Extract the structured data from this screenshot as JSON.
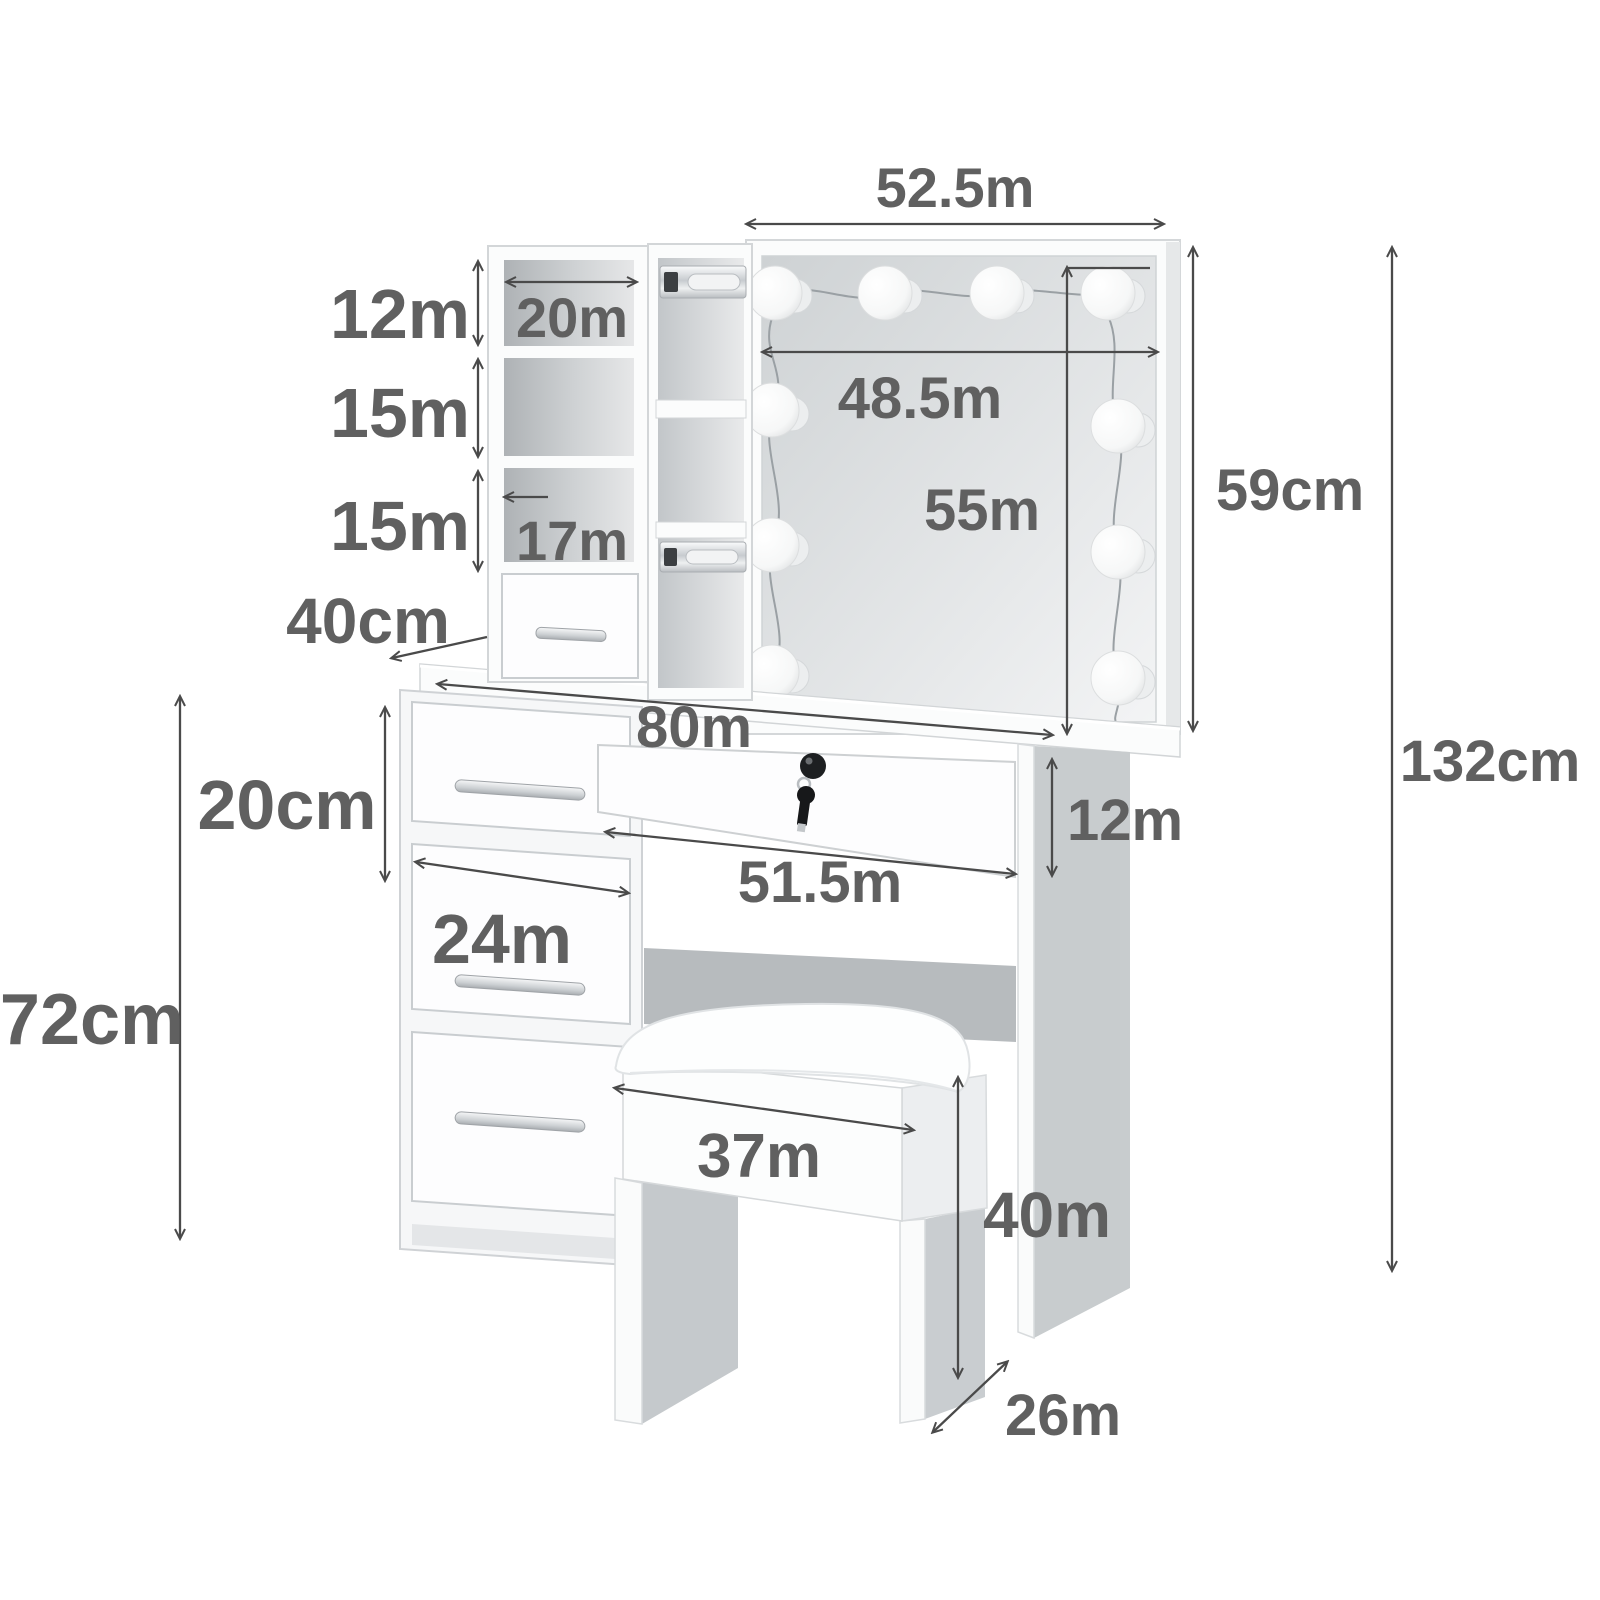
{
  "figure": {
    "kind": "furniture-dimension-diagram",
    "background": "#ffffff"
  },
  "colors": {
    "label": "#606060",
    "arrow": "#4a4a4a",
    "panel_shadow": "#c8ccce",
    "glass": "#d8dbdd",
    "furniture": "#fbfcfc"
  },
  "scene": {
    "mirror_bulb_count": 10,
    "hutch_cubby_count": 3,
    "hutch_drawer_count": 1,
    "cabinet_drawer_count": 3,
    "center_drawer_has_lock": true,
    "has_stool": true
  },
  "dims": {
    "mirror_width": "52.5m",
    "top_cubby_height": "12m",
    "top_cubby_width": "20m",
    "middle_cubby_height": "15m",
    "bottom_cubby_height": "15m",
    "bottom_cubby_width": "17m",
    "hutch_drawer_depth": "40cm",
    "mirror_glass_width": "48.5m",
    "mirror_glass_height": "55m",
    "mirror_height": "59cm",
    "tabletop_width": "80m",
    "side_drawer_height": "20cm",
    "center_drawer_height": "12m",
    "center_drawer_width": "51.5m",
    "side_drawer_width": "24m",
    "table_height": "72cm",
    "overall_height": "132cm",
    "stool_width": "37m",
    "stool_height": "40m",
    "stool_depth": "26m"
  }
}
